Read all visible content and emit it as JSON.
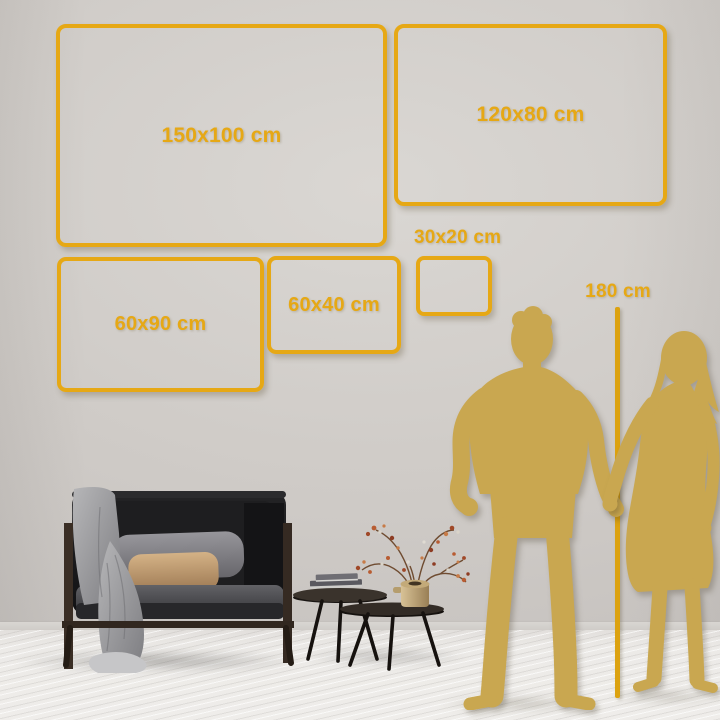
{
  "sizes": {
    "frames": [
      {
        "label": "150x100 cm",
        "width_cm": 150,
        "height_cm": 100
      },
      {
        "label": "120x80 cm",
        "width_cm": 120,
        "height_cm": 80
      },
      {
        "label": "60x90 cm",
        "width_cm": 60,
        "height_cm": 90
      },
      {
        "label": "60x40 cm",
        "width_cm": 60,
        "height_cm": 40
      },
      {
        "label": "30x20 cm",
        "width_cm": 30,
        "height_cm": 20
      }
    ],
    "person_height": {
      "label": "180 cm",
      "value_cm": 180
    }
  },
  "colors": {
    "accent_gold": "#E6A815",
    "ruler_gold": "#DCA210",
    "silhouette_gold": "#C9A750",
    "wall": "#CDC9C5",
    "floor": "#E9E7E4"
  },
  "scene": {
    "figures": [
      "man-silhouette",
      "woman-silhouette"
    ],
    "furniture": [
      "sofa",
      "throw-blanket",
      "pillows",
      "coffee-table-tall",
      "coffee-table-low",
      "books",
      "plant-vase"
    ]
  }
}
